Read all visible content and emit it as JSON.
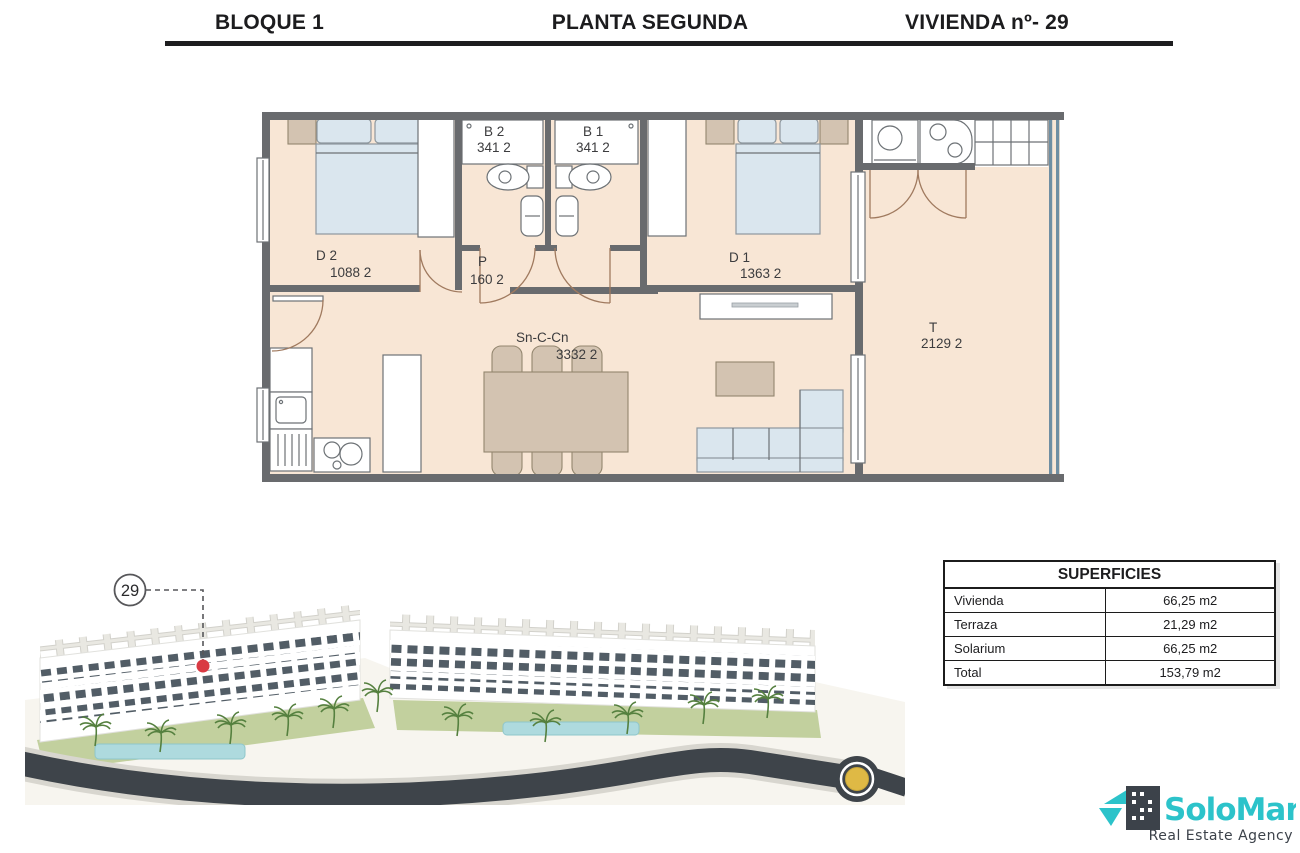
{
  "header": {
    "block": "BLOQUE 1",
    "floor": "PLANTA SEGUNDA",
    "unit": "VIVIENDA nº- 29"
  },
  "floorplan": {
    "rooms": {
      "d2": {
        "code": "D 2",
        "area": "1088 2"
      },
      "b2": {
        "code": "B 2",
        "area": "341 2"
      },
      "b1": {
        "code": "B 1",
        "area": "341 2"
      },
      "d1": {
        "code": "D 1",
        "area": "1363 2"
      },
      "p": {
        "code": "P",
        "area": "160 2"
      },
      "sncc": {
        "code": "Sn-C-Cn",
        "area": "3332 2"
      },
      "t": {
        "code": "T",
        "area": "2129 2"
      }
    }
  },
  "site_plan": {
    "unit_marker": "29"
  },
  "surfaces_table": {
    "title": "SUPERFICIES",
    "rows": [
      {
        "label": "Vivienda",
        "value": "66,25 m2"
      },
      {
        "label": "Terraza",
        "value": "21,29 m2"
      },
      {
        "label": "Solarium",
        "value": "66,25 m2"
      },
      {
        "label": "Total",
        "value": "153,79 m2"
      }
    ]
  },
  "logo": {
    "name": "SoloMar",
    "tagline": "Real Estate Agency"
  },
  "colors": {
    "wall": "#696b6e",
    "floor": "#f8e6d5",
    "bed": "#dae6ee",
    "bed-edge": "#8d979e",
    "tan": "#d3c3b1",
    "tan-edge": "#93866f",
    "line": "#6d7276",
    "door": "#a07a5f",
    "balustrade": "#6f8ea2",
    "marker-red": "#d93a43",
    "teal": "#2cc3ca",
    "logo-dark": "#3c424a",
    "road": "#3e444a",
    "grass": "#b9c98f",
    "pool": "#aedade",
    "roundabout-center": "#dfb945"
  }
}
